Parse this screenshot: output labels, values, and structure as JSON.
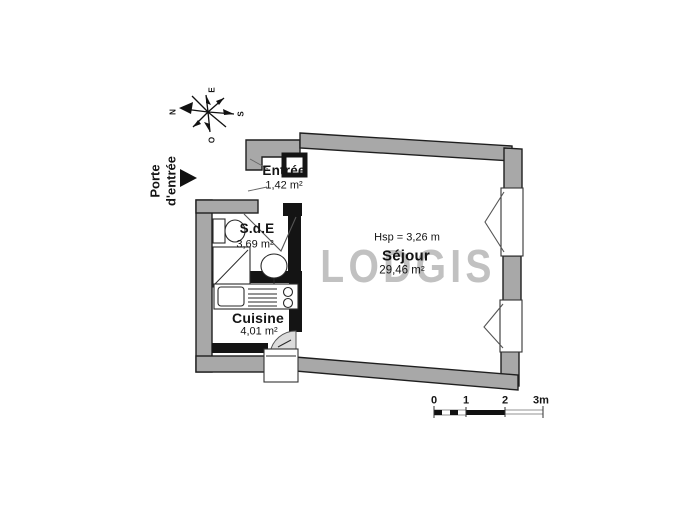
{
  "watermark": "LODGIS",
  "compass": {
    "north": "N",
    "east": "E",
    "south": "S",
    "west": "O"
  },
  "entrance": {
    "label": "Porte d'entrée"
  },
  "rooms": {
    "entree": {
      "name": "Entrée",
      "area": "1,42 m²"
    },
    "sde": {
      "name": "S.d.E",
      "area": "3,69 m²"
    },
    "cuisine": {
      "name": "Cuisine",
      "area": "4,01 m²"
    },
    "sejour": {
      "name": "Séjour",
      "area": "29,46 m²",
      "ceiling_height": "Hsp = 3,26 m"
    }
  },
  "scale_bar": {
    "labels": [
      "0",
      "1",
      "2",
      "3m"
    ]
  },
  "colors": {
    "wall": "#a8a8a8",
    "outline": "#1f1f1f",
    "partition": "#141414",
    "watermark": "#b2b2b2"
  }
}
